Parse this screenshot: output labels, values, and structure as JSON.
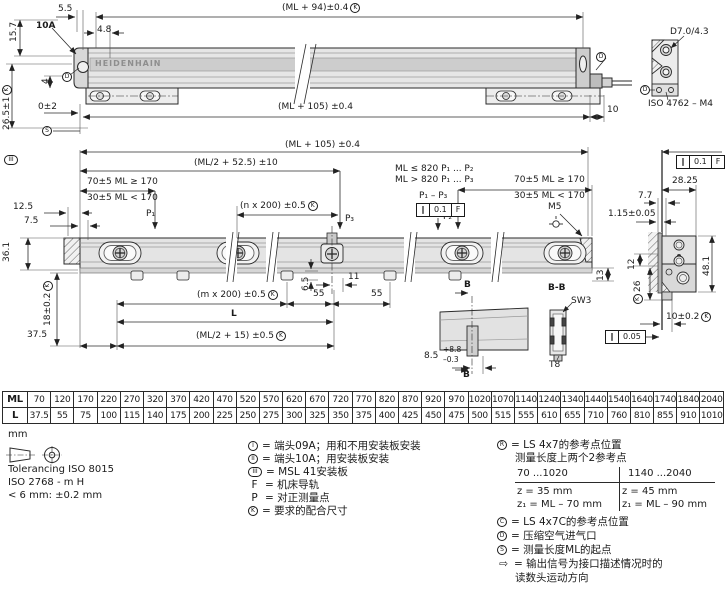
{
  "symbols": {
    "K": "K",
    "S": "S",
    "D": "D",
    "R": "R",
    "C": "C",
    "I": "I",
    "II": "II",
    "III": "III",
    "F": "F",
    "P": "P",
    "par": "∥",
    "arrow": "⇨"
  },
  "brand": "HEIDENHAIN",
  "top_view": {
    "d55": "5.5",
    "head": "10A",
    "d48": "4.8",
    "d157": "15.7",
    "d4": "4",
    "ml94": "(ML + 94)±0.4",
    "d265": "26.5±1",
    "d02": "0±2",
    "ml105": "(ML + 105) ±0.4",
    "d10": "10",
    "bore": "D7.0/4.3",
    "screw": "ISO 4762 – M4"
  },
  "plan_view": {
    "ml105": "(ML + 105) ±0.4",
    "ml2_525": "(ML/2 + 52.5) ±10",
    "d70a": "70±5 ML ≥ 170",
    "d30a": "30±5 ML < 170",
    "d125": "12.5",
    "d75": "7.5",
    "nx200": "(n x 200) ±0.5",
    "p1": "P₁",
    "p2": "P₂",
    "p3": "P₃",
    "cond1": "ML ≤ 820  P₁ ... P₂",
    "cond2": "ML > 820  P₁ ... P₃",
    "p1p3": "P₁ – P₃",
    "tol_val": "0.1",
    "tol_ref": "F",
    "d70b": "70±5 ML ≥ 170",
    "d30b": "30±5 ML < 170",
    "m5": "M5",
    "d361": "36.1",
    "d18": "18±0.2",
    "d375": "37.5",
    "d65": "6.5",
    "d11": "11",
    "d55a": "55",
    "d55b": "55",
    "mx200": "(m x 200) ±0.5",
    "l": "L",
    "ml2_15": "(ML/2 + 15) ±0.5",
    "d13": "13",
    "b1": "B",
    "b2": "B",
    "bb": "B-B",
    "sw3": "SW3",
    "t8": "T8",
    "d85": "8.5",
    "d85_plus": "+8.8",
    "d85_minus": "–0.3"
  },
  "cross_section": {
    "tol_val": "0.1",
    "tol_ref": "F",
    "d2825": "28.25",
    "d77": "7.7",
    "d115": "1.15±0.05",
    "d12": "12",
    "d481": "48.1",
    "d26": "26",
    "d10": "10±0.2",
    "tol2_val": "0.05"
  },
  "table": {
    "row_ml": "ML",
    "row_l": "L",
    "ml": [
      "70",
      "120",
      "170",
      "220",
      "270",
      "320",
      "370",
      "420",
      "470",
      "520",
      "570",
      "620",
      "670",
      "720",
      "770",
      "820",
      "870",
      "920",
      "970",
      "1020",
      "1070",
      "1140",
      "1240",
      "1340",
      "1440",
      "1540",
      "1640",
      "1740",
      "1840",
      "2040"
    ],
    "l": [
      "37.5",
      "55",
      "75",
      "100",
      "115",
      "140",
      "175",
      "200",
      "225",
      "250",
      "275",
      "300",
      "325",
      "350",
      "375",
      "400",
      "425",
      "450",
      "475",
      "500",
      "515",
      "555",
      "610",
      "655",
      "710",
      "760",
      "810",
      "855",
      "910",
      "1010"
    ]
  },
  "notes": {
    "unit": "mm",
    "tol": "Tolerancing ISO 8015",
    "iso": "ISO 2768 - m H",
    "small": "< 6 mm: ±0.2 mm"
  },
  "legend_parts": {
    "i1": "= 端头09A；用和不用安装板安装",
    "i2": "= 端头10A；用安装板安装",
    "i3": "= MSL 41安装板",
    "i4": "= 机床导轨",
    "i5": "= 对正测量点",
    "i6": "= 要求的配合尺寸"
  },
  "legend_refs": {
    "r1": "= LS 4x7的参考点位置",
    "r2": "测量长度上两个2参考点",
    "tbl": {
      "h1": "70 ...1020",
      "h2": "1140 ...2040",
      "a1": "z  = 35 mm",
      "a2": "z₁ = ML – 70 mm",
      "b1": "z  = 45 mm",
      "b2": "z₁ = ML – 90 mm"
    },
    "c": "= LS 4x7C的参考点位置",
    "d": "= 压缩空气进气口",
    "s": "= 测量长度ML的起点",
    "o1": "= 输出信号为接口描述情况时的",
    "o2": "读数头运动方向"
  }
}
